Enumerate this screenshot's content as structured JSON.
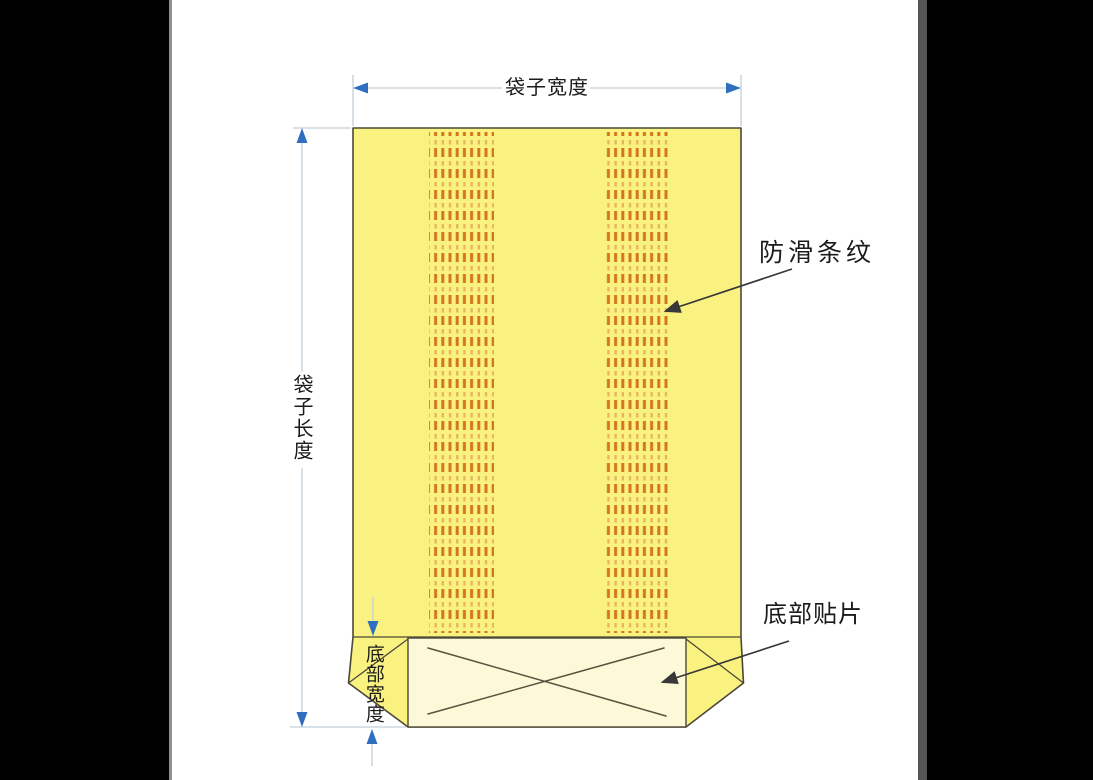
{
  "diagram": {
    "title": "bag-structure-diagram",
    "labels": {
      "bag_width": "袋子宽度",
      "bag_length": "袋子长度",
      "anti_slip_stripes": "防滑条纹",
      "bottom_patch": "底部贴片",
      "bottom_width": "底部宽度"
    },
    "colors": {
      "bag_fill": "#f9f281",
      "gusset_fill": "#fcf9d8",
      "outline": "#4c4836",
      "stripe_strong": "#d4771c",
      "stripe_light": "#e9b45b",
      "dim_line": "#c3d0da",
      "arrow_blue": "#2f6fc0",
      "leader": "#383838",
      "text": "#1b1b1b",
      "left_bar": "#000000",
      "right_bar": "#000000",
      "left_divider": "#909090",
      "right_divider": "#555555"
    }
  }
}
